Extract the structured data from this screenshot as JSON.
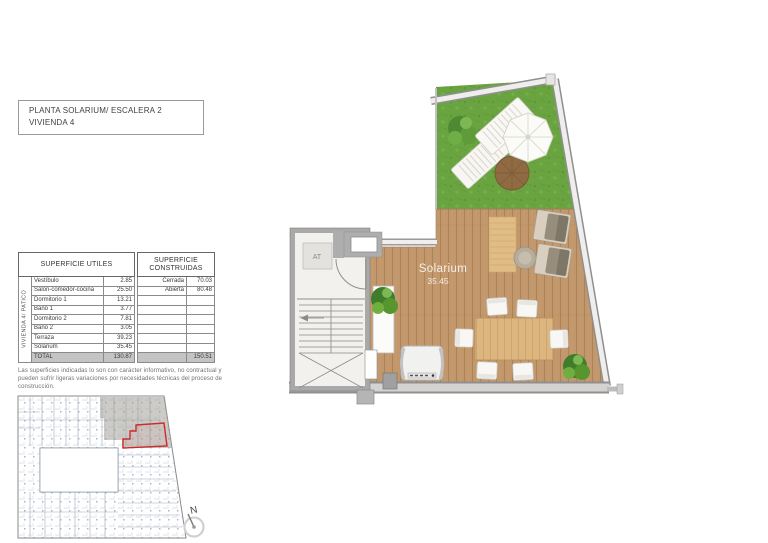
{
  "title_box": {
    "line1": "PLANTA SOLARIUM/ ESCALERA 2",
    "line2": "VIVIENDA 4"
  },
  "table": {
    "left_header": "SUPERFICIE UTILES",
    "right_header": "SUPERFICIE CONSTRUIDAS",
    "side_label": "VIVIENDA 4/ PATICO",
    "rows": [
      {
        "label": "Vestíbulo",
        "value": "2.85",
        "rlabel": "Cerrada",
        "rvalue": "70.03"
      },
      {
        "label": "Salon-comedor-cocina",
        "value": "25.50",
        "rlabel": "Abierta",
        "rvalue": "80.48"
      },
      {
        "label": "Dormitorio 1",
        "value": "13.21",
        "rlabel": "",
        "rvalue": ""
      },
      {
        "label": "Baño 1",
        "value": "3.77",
        "rlabel": "",
        "rvalue": ""
      },
      {
        "label": "Dormitorio 2",
        "value": "7.81",
        "rlabel": "",
        "rvalue": ""
      },
      {
        "label": "Baño 2",
        "value": "3.05",
        "rlabel": "",
        "rvalue": ""
      },
      {
        "label": "Terraza",
        "value": "39.23",
        "rlabel": "",
        "rvalue": ""
      },
      {
        "label": "Solarium",
        "value": "35.45",
        "rlabel": "",
        "rvalue": ""
      }
    ],
    "total": {
      "label": "TOTAL",
      "value": "130.87",
      "rvalue": "150.51"
    }
  },
  "disclaimer": "Las superficies indicadas lo son con carácter informativo, no contractual y pueden sufrir ligeras variaciones por necesidades técnicas del proceso de construcción.",
  "plan": {
    "room_label": "Solarium",
    "room_area": "35.45",
    "elevator_label": "AT"
  },
  "compass": {
    "label": "N"
  },
  "colors": {
    "grass": "#6aa440",
    "deck": "#c2976b",
    "wall_gray": "#a9a9a9",
    "accent_red": "#cc2b2b"
  }
}
